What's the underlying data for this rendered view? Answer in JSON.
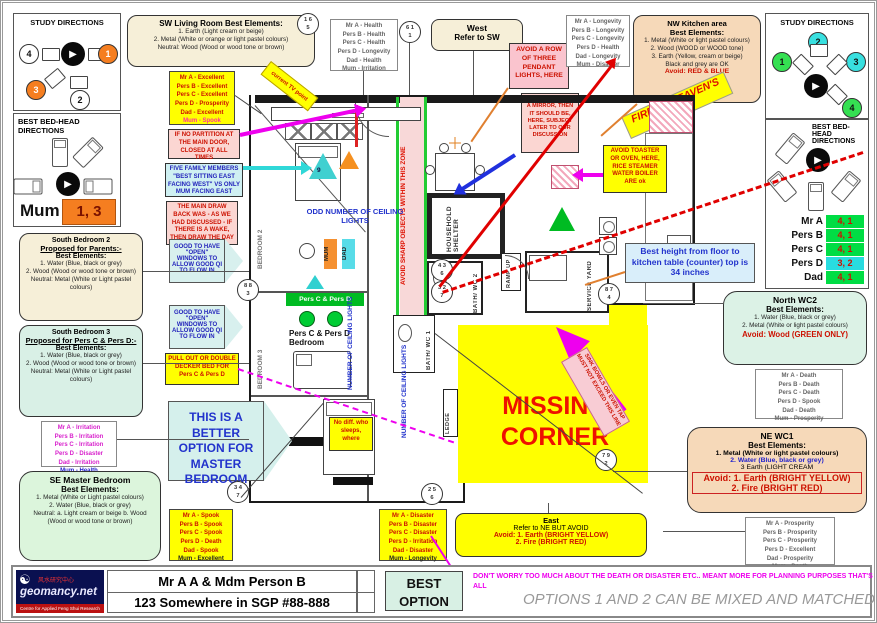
{
  "icons": {
    "compass_arrow": "▶",
    "yin_yang": "☯"
  },
  "left_study": {
    "title": "STUDY DIRECTIONS",
    "d1": "4",
    "d2": "1",
    "d3": "3",
    "d4": "2"
  },
  "left_bedhead": {
    "title": "BEST BED-HEAD DIRECTIONS",
    "person": "Mum",
    "value": "1, 3"
  },
  "right_study": {
    "title": "STUDY DIRECTIONS",
    "d1": "1",
    "d2": "2",
    "d3": "3",
    "d4": "4"
  },
  "right_bedhead": {
    "title": "BEST BED-HEAD DIRECTIONS",
    "rows": [
      {
        "name": "Mr A",
        "value": "4, 1",
        "cls": "green"
      },
      {
        "name": "Pers B",
        "value": "4, 1",
        "cls": "green"
      },
      {
        "name": "Pers C",
        "value": "4, 1",
        "cls": "green"
      },
      {
        "name": "Pers D",
        "value": "3, 2",
        "cls": "cyan"
      },
      {
        "name": "Dad",
        "value": "4, 1",
        "cls": "green"
      }
    ]
  },
  "boxes": {
    "sw_living": {
      "title": "SW Living Room Best Elements:",
      "lines": [
        "1. Earth (Light cream or beige)",
        "2. Metal (White or orange or light pastel colours)",
        "Neutral: Wood (Wood or wood tone or brown)"
      ]
    },
    "nw_kitchen": {
      "title": "NW Kitchen area",
      "heading": "Best Elements:",
      "lines": [
        "1. Metal (White or light pastel colours)",
        "2. Wood (WOOD or WOOD tone)",
        "3. Earth (Yellow, cream or beige)",
        "Black and grey are OK"
      ],
      "avoid": "Avoid: RED & BLUE"
    },
    "west": {
      "title": "West",
      "line": "Refer to SW"
    },
    "east": {
      "title": "East",
      "line": "Refer to NE BUT AVOID",
      "avoid1": "Avoid: 1. Earth (BRIGHT YELLOW)",
      "avoid2": "2. Fire (BRIGHT RED)"
    },
    "north_wc2": {
      "title": "North WC2",
      "heading": "Best Elements:",
      "lines": [
        "1. Water (Blue, black or grey)",
        "2. Metal (White or light pastel colours)"
      ],
      "avoid": "Avoid: Wood (GREEN ONLY)"
    },
    "ne_wc1": {
      "title": "NE  WC1",
      "heading": "Best Elements:",
      "line1": "1. Metal (White or light pastel colours)",
      "line2": "2. Water (Blue, black or grey)",
      "line3": "3  Earth (LIGHT CREAM",
      "avoid1": "Avoid: 1. Earth (BRIGHT YELLOW)",
      "avoid2": "2. Fire (BRIGHT RED)"
    },
    "south_bedroom2": {
      "title": "South Bedroom 2",
      "subtitle": "Proposed for Parents:-",
      "heading": "Best Elements:",
      "lines": [
        "1. Water (Blue, black or grey)",
        "2. Wood (Wood or wood tone or brown)",
        "Neutral: Metal (White or Light pastel colours)"
      ]
    },
    "south_bedroom3": {
      "title": "South Bedroom 3",
      "subtitle": "Proposed for Pers C & Pers D:-",
      "heading": "Best Elements:",
      "lines": [
        "1. Water (Blue, black or grey)",
        "2. Wood (Wood or wood tone or brown)",
        "Neutral: Metal (White or Light pastel colours)"
      ]
    },
    "se_master": {
      "title": "SE Master Bedroom",
      "heading": "Best Elements:",
      "lines": [
        "1. Metal (White or Light pastel colours)",
        "2. Water (Blue, black or grey)",
        "Neutral: a. Light cream or beige b. Wood (Wood or wood tone or brown)"
      ]
    }
  },
  "lists": {
    "excellent": [
      "Mr A -  Excellent",
      "Pers B -  Excellent",
      "Pers C -  Excellent",
      "Pers D -  Prosperity",
      "Dad -  Excellent",
      "Mum -  Spook"
    ],
    "health": [
      "Mr A -  Health",
      "Pers B -  Health",
      "Pers C -  Health",
      "Pers D -  Longevity",
      "Dad -  Health",
      "Mum -  Irritation"
    ],
    "longevity": [
      "Mr A -  Longevity",
      "Pers B -  Longevity",
      "Pers C -  Longevity",
      "Pers D -  Health",
      "Dad -  Longevity",
      "Mum -  Disaster"
    ],
    "death": [
      "Mr A -  Death",
      "Pers B -  Death",
      "Pers C -  Death",
      "Pers D -  Spook",
      "Dad -  Death",
      "Mum -  Prosperity"
    ],
    "prosperity": [
      "Mr A -  Prosperity",
      "Pers B -  Prosperity",
      "Pers C -  Prosperity",
      "Pers D -  Excellent",
      "Dad -  Prosperity",
      "Mum -  Death"
    ],
    "irritation": [
      "Mr A -  Irritation",
      "Pers B -  Irritation",
      "Pers C -  Irritation",
      "Pers D -  Disaster",
      "Dad -  Irritation",
      "Mum -  Health"
    ],
    "spook": [
      "Mr A -  Spook",
      "Pers B -  Spook",
      "Pers C -  Spook",
      "Pers D -  Death",
      "Dad -  Spook",
      "Mum -  Excellent"
    ],
    "disaster": [
      "Mr A -  Disaster",
      "Pers B -  Disaster",
      "Pers C -  Disaster",
      "Pers D -  Irritation",
      "Dad -  Disaster",
      "Mum -  Longevity"
    ]
  },
  "notes": {
    "no_partition": "IF NO PARTITION AT THE MAIN DOOR, CLOSED AT ALL TIMES",
    "five_family": "FIVE FAMILY MEMBERS \"BEST SITTING EAST FACING WEST\" VS ONLY MUM FACING EAST",
    "drawback": "THE MAIN DRAW BACK WAS - AS WE HAD DISCUSSED - IF THERE IS A WAKE, THEN DRAW THE DAY CURTAIN",
    "open_windows": "GOOD TO HAVE \"OPEN\" WINDOWS TO ALLOW GOOD QI TO FLOW IN",
    "pull_out": "PULL OUT OR DOUBLE DECKER BED FOR Pers C & Pers D",
    "better_option": "THIS IS A BETTER OPTION FOR MASTER BEDROOM",
    "no_diff": "No diff. who sleeps, where",
    "pendant": "AVOID A ROW OF THREE PENDANT LIGHTS, HERE",
    "mirror": "IN CASE IF WANT A MIRROR, THEN IT SHOULD BE, HERE, SUBJECT LATER TO OUR DISCUSSION",
    "toaster": "AVOID TOASTER OR OVEN, HERE, RICE STEAMER WATER BOILER ARE ok",
    "counter_height": "Best height from floor to kitchen table (counter) top is 34 inches",
    "fire_gate": "FIRE AT HEAVEN'S GATE",
    "current_tv": "current TV point",
    "sink_bowls": "SINK BOWLS OR EVEN TAP MUST NOT EXCEED THIS LINE"
  },
  "plan": {
    "avoid_sharp": "AVOID SHARP OBJECTS WITHIN THIS ZONE",
    "odd_lights": "ODD NUMBER OF CEILING LIGHTS",
    "num_lights": "NUMBER OF CEILING LIGHTS",
    "missing_corner": "MISSING CORNER",
    "household_shelter": "HOUSEHOLD SHELTER",
    "bath_wc2": "BATH/ WC 2",
    "bath_wc1": "BATH/ WC 1",
    "ramp_up": "RAMP UP",
    "service_yard": "SERVICE YARD",
    "ledge": "LEDGE",
    "bedroom2": "BEDROOM 2",
    "bedroom3": "BEDROOM 3",
    "pers_cd_bar": "Pers C & Pers D",
    "pers_cd_bedroom": "Pers C & Pers D Bedroom",
    "mum": "MUM",
    "dad": "DAD",
    "tri9": "9"
  },
  "circles": {
    "c165": {
      "t": "1 6",
      "b": "5"
    },
    "c611": {
      "t": "6 1",
      "b": "1"
    },
    "c883": {
      "t": "8 8",
      "b": "3"
    },
    "c347": {
      "t": "3 4",
      "b": "7"
    },
    "c436": {
      "t": "4 3",
      "b": "6"
    },
    "c327": {
      "t": "3 2",
      "b": "7"
    },
    "c874": {
      "t": "8 7",
      "b": "4"
    },
    "c256": {
      "t": "2 5",
      "b": "6"
    },
    "c792": {
      "t": "7 9",
      "b": "2"
    }
  },
  "footer": {
    "name": "Mr A A & Mdm Person B",
    "address": "123 Somewhere in SGP #88-888",
    "best_option": "BEST OPTION",
    "dont_worry": "DON'T WORRY TOO MUCH ABOUT THE DEATH OR DISASTER ETC.. MEANT MORE FOR PLANNING PURPOSES THAT'S ALL",
    "options": "OPTIONS 1 AND 2 CAN BE MIXED AND MATCHED",
    "logo_domain": "geomancy.net",
    "logo_cn": "风水研究中心",
    "logo_tagline": "Centre for Applied Feng Shui Research"
  },
  "colors": {
    "accent_yellow": "#ffff00",
    "badge_green": "#00dd44",
    "badge_cyan": "#28dce0",
    "warn_red": "#cc1100",
    "magenta": "#ee00ee"
  }
}
